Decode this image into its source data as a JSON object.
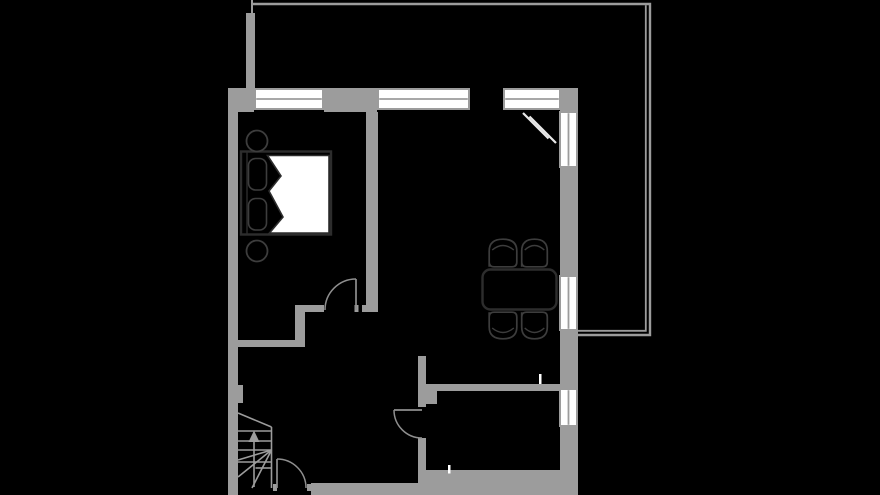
{
  "canvas": {
    "width": 880,
    "height": 495,
    "background": "#000000"
  },
  "palette": {
    "wall": "#9c9c9c",
    "window_fill": "#ffffff",
    "window_divider": "#9c9c9c",
    "door_line": "#8f8f8f",
    "stair_line": "#9c9c9c",
    "balcony_line": "#9c9c9c",
    "furniture_dark": "#2d2d2d",
    "furniture_mid": "#3d3d3d",
    "duvet_fill": "#ffffff",
    "open_leaf": "#e8e8e8",
    "tick_white": "#ffffff",
    "floor": "#000000"
  },
  "walls": [
    {
      "name": "wall-top-left-corner",
      "x": 228,
      "y": 88,
      "w": 26,
      "h": 24
    },
    {
      "name": "wall-top-mid",
      "x": 324,
      "y": 88,
      "w": 53,
      "h": 24
    },
    {
      "name": "wall-top-right-corner",
      "x": 560,
      "y": 88,
      "w": 18,
      "h": 23
    },
    {
      "name": "wall-right-seg1",
      "x": 560,
      "y": 168,
      "w": 18,
      "h": 107
    },
    {
      "name": "wall-right-seg2",
      "x": 560,
      "y": 331,
      "w": 18,
      "h": 57
    },
    {
      "name": "wall-right-seg3",
      "x": 560,
      "y": 427,
      "w": 18,
      "h": 68
    },
    {
      "name": "wall-left",
      "x": 228,
      "y": 88,
      "w": 10,
      "h": 407
    },
    {
      "name": "wall-bedroom-living-divider",
      "x": 366,
      "y": 112,
      "w": 12,
      "h": 193
    },
    {
      "name": "wall-divider-foot",
      "x": 362,
      "y": 305,
      "w": 16,
      "h": 7
    },
    {
      "name": "wall-bedroom-south-upper",
      "x": 304,
      "y": 305,
      "w": 20,
      "h": 7
    },
    {
      "name": "wall-bedroom-doorstop",
      "x": 354.5,
      "y": 305,
      "w": 4,
      "h": 7
    },
    {
      "name": "wall-bedroom-step",
      "x": 295,
      "y": 305,
      "w": 10,
      "h": 42
    },
    {
      "name": "wall-bedroom-south-lower",
      "x": 238,
      "y": 340,
      "w": 67,
      "h": 7
    },
    {
      "name": "wall-left-pier",
      "x": 238,
      "y": 385,
      "w": 5,
      "h": 18
    },
    {
      "name": "wall-bath-stub-upper",
      "x": 418,
      "y": 356,
      "w": 8,
      "h": 51
    },
    {
      "name": "wall-bath-doorstop",
      "x": 418,
      "y": 438,
      "w": 8,
      "h": 4
    },
    {
      "name": "wall-bath-stub-lower",
      "x": 418,
      "y": 442,
      "w": 8,
      "h": 41
    },
    {
      "name": "wall-bath-pier",
      "x": 426,
      "y": 391,
      "w": 11,
      "h": 13
    },
    {
      "name": "wall-bath-top",
      "x": 426,
      "y": 384,
      "w": 134,
      "h": 7
    },
    {
      "name": "wall-bottom-entry",
      "x": 311,
      "y": 483,
      "w": 107,
      "h": 12
    },
    {
      "name": "wall-entry-doorstop-left",
      "x": 273,
      "y": 484,
      "w": 4,
      "h": 7
    },
    {
      "name": "wall-entry-doorstop-right",
      "x": 307,
      "y": 484,
      "w": 4,
      "h": 7
    },
    {
      "name": "wall-bottom-bath",
      "x": 418,
      "y": 470,
      "w": 160,
      "h": 25
    },
    {
      "name": "wall-balcony-stub",
      "x": 246,
      "y": 13,
      "w": 9,
      "h": 75
    }
  ],
  "windows": [
    {
      "name": "window-bedroom-top",
      "x": 254,
      "y": 88,
      "w": 70,
      "h": 22,
      "divider": "h"
    },
    {
      "name": "window-living-top",
      "x": 377,
      "y": 88,
      "w": 93,
      "h": 22,
      "divider": "h"
    },
    {
      "name": "window-balcony-top",
      "x": 503,
      "y": 88,
      "w": 58,
      "h": 22,
      "divider": "h"
    },
    {
      "name": "window-right-upper",
      "x": 559,
      "y": 111,
      "w": 19,
      "h": 57,
      "divider": "v"
    },
    {
      "name": "window-right-middle",
      "x": 559,
      "y": 275,
      "w": 19,
      "h": 56,
      "divider": "v"
    },
    {
      "name": "window-right-lower",
      "x": 559,
      "y": 388,
      "w": 19,
      "h": 39,
      "divider": "v"
    }
  ],
  "doors": [
    {
      "name": "door-bedroom",
      "leaf": [
        356,
        310,
        356,
        279
      ],
      "arc": {
        "sx": 356,
        "sy": 279,
        "r": 31,
        "ex": 325,
        "ey": 310,
        "sweep": 0
      }
    },
    {
      "name": "door-bathroom",
      "leaf": [
        422,
        410,
        394,
        410
      ],
      "arc": {
        "sx": 394,
        "sy": 410,
        "r": 28,
        "ex": 422,
        "ey": 438,
        "sweep": 0
      }
    },
    {
      "name": "door-entry",
      "leaf": [
        277,
        488,
        277,
        459
      ],
      "arc": {
        "sx": 277,
        "sy": 459,
        "r": 29,
        "ex": 306,
        "ey": 488,
        "sweep": 1
      }
    }
  ],
  "open_door_leaf": {
    "name": "balcony-door-open-leaf",
    "lines": [
      [
        523,
        113,
        548.5,
        138.5
      ],
      [
        529.5,
        116.5,
        556,
        143
      ]
    ]
  },
  "stairs": {
    "name": "staircase",
    "lines": [
      [
        238,
        413,
        271.5,
        427
      ],
      [
        271.5,
        427,
        271.5,
        488
      ],
      [
        238,
        431,
        271.5,
        431
      ],
      [
        238,
        441,
        271.5,
        441
      ],
      [
        238,
        450,
        271.5,
        450
      ],
      [
        238,
        462,
        271.5,
        462
      ],
      [
        255.5,
        468,
        271.5,
        468
      ],
      [
        271.5,
        450,
        238,
        460
      ],
      [
        271.5,
        450,
        238,
        477
      ],
      [
        271.5,
        450,
        252,
        488
      ],
      [
        254,
        487,
        254,
        441
      ]
    ],
    "arrow_head": [
      [
        254,
        430.5
      ],
      [
        248.5,
        442
      ],
      [
        259.5,
        442
      ]
    ]
  },
  "furniture": {
    "bed": {
      "name": "double-bed",
      "frame": {
        "x": 241,
        "y": 151.5,
        "w": 90,
        "h": 83
      },
      "headboard_line": [
        247,
        152.5,
        247,
        233.5
      ],
      "pillows": [
        {
          "x": 248.5,
          "y": 158.5,
          "w": 18,
          "h": 31.5
        },
        {
          "x": 248.5,
          "y": 198.5,
          "w": 18,
          "h": 31.5
        }
      ],
      "duvet_polygon": [
        [
          267.5,
          155.5
        ],
        [
          329,
          155.5
        ],
        [
          329,
          233
        ],
        [
          269.5,
          233
        ],
        [
          283,
          217
        ],
        [
          269,
          191
        ],
        [
          281,
          176
        ]
      ]
    },
    "side_tables": [
      {
        "name": "bedside-stool-top",
        "cx": 257,
        "cy": 141,
        "r": 10.5
      },
      {
        "name": "bedside-stool-bottom",
        "cx": 257,
        "cy": 251,
        "r": 10.5
      }
    ],
    "dining_table": {
      "name": "dining-table",
      "x": 482.5,
      "y": 269.5,
      "w": 74,
      "h": 40,
      "rx": 8
    },
    "chairs": [
      {
        "name": "chair-top-left",
        "x": 488,
        "y": 238,
        "w": 30,
        "h": 30,
        "facing": "up"
      },
      {
        "name": "chair-top-right",
        "x": 520.5,
        "y": 238,
        "w": 28,
        "h": 30,
        "facing": "up"
      },
      {
        "name": "chair-bottom-left",
        "x": 488,
        "y": 311,
        "w": 30,
        "h": 29,
        "facing": "down"
      },
      {
        "name": "chair-bottom-right",
        "x": 520.5,
        "y": 311,
        "w": 28,
        "h": 29,
        "facing": "down"
      }
    ]
  },
  "balcony": {
    "name": "balcony-outline",
    "outer": [
      [
        253,
        4
      ],
      [
        650,
        4
      ],
      [
        650,
        335
      ],
      [
        578,
        335
      ]
    ],
    "inner": [
      [
        645.8,
        5.2
      ],
      [
        645.8,
        330.8
      ],
      [
        578,
        330.8
      ]
    ],
    "stub_line": [
      252,
      0,
      252,
      13
    ]
  },
  "ticks": [
    {
      "name": "vent-tick-dining",
      "x": 538.8,
      "y": 374,
      "w": 2.6,
      "h": 10
    },
    {
      "name": "vent-tick-bath",
      "x": 447.8,
      "y": 465,
      "w": 2.6,
      "h": 8.5
    }
  ]
}
